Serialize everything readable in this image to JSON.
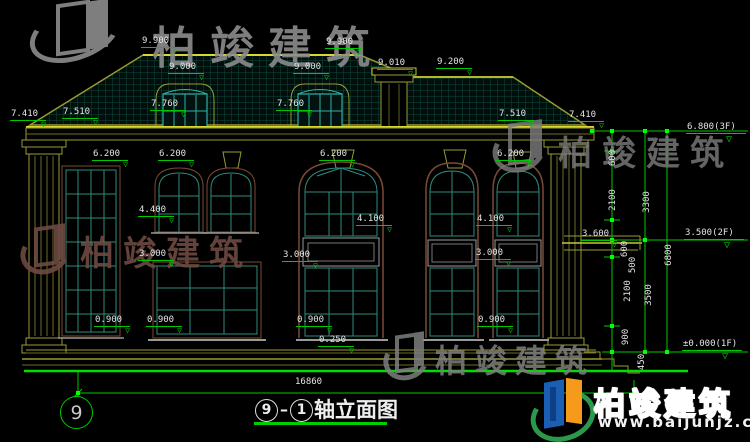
{
  "brand": {
    "name": "柏竣建筑",
    "url": "www.baijunjz.com"
  },
  "figure": {
    "axis_start": "9",
    "separator": "–",
    "axis_end": "1",
    "title": "轴立面图",
    "axis_bubble": "9",
    "total_width": "16860"
  },
  "drawing": {
    "type": "architectural-elevation",
    "floor_levels": [
      "±0.000(1F)",
      "3.500(2F)",
      "6.800(3F)"
    ],
    "colors": {
      "line_green": "#00c800",
      "grip_green": "#00ff00",
      "trim_yellow": "#9a9a35",
      "bright_yellow": "#d8d830",
      "window_teal": "#2e8b7b",
      "frame_brown": "#7a4a35"
    }
  },
  "dim_labels": [
    {
      "t": "9.900",
      "x": 141,
      "y": 36
    },
    {
      "t": "9.900",
      "x": 325,
      "y": 37
    },
    {
      "t": "9.000",
      "x": 168,
      "y": 62
    },
    {
      "t": "9.000",
      "x": 293,
      "y": 62
    },
    {
      "t": "9.010",
      "x": 377,
      "y": 58
    },
    {
      "t": "9.200",
      "x": 436,
      "y": 57
    },
    {
      "t": "7.760",
      "x": 150,
      "y": 99
    },
    {
      "t": "7.760",
      "x": 276,
      "y": 99
    },
    {
      "t": "7.410",
      "x": 10,
      "y": 109
    },
    {
      "t": "7.510",
      "x": 62,
      "y": 107
    },
    {
      "t": "7.510",
      "x": 498,
      "y": 109
    },
    {
      "t": "7.410",
      "x": 568,
      "y": 110
    },
    {
      "t": "6.200",
      "x": 92,
      "y": 149
    },
    {
      "t": "6.200",
      "x": 158,
      "y": 149
    },
    {
      "t": "6.200",
      "x": 319,
      "y": 149
    },
    {
      "t": "6.200",
      "x": 496,
      "y": 149
    },
    {
      "t": "4.400",
      "x": 138,
      "y": 205
    },
    {
      "t": "4.100",
      "x": 356,
      "y": 214
    },
    {
      "t": "4.100",
      "x": 476,
      "y": 214
    },
    {
      "t": "3.000",
      "x": 138,
      "y": 249
    },
    {
      "t": "3.000",
      "x": 282,
      "y": 250
    },
    {
      "t": "3.000",
      "x": 475,
      "y": 248
    },
    {
      "t": "3.600",
      "x": 581,
      "y": 229
    },
    {
      "t": "0.900",
      "x": 94,
      "y": 315
    },
    {
      "t": "0.900",
      "x": 146,
      "y": 315
    },
    {
      "t": "0.900",
      "x": 296,
      "y": 315
    },
    {
      "t": "0.900",
      "x": 477,
      "y": 315
    },
    {
      "t": "0.250",
      "x": 318,
      "y": 335
    },
    {
      "t": "6.800(3F)",
      "x": 686,
      "y": 122,
      "cls": "big"
    },
    {
      "t": "3.500(2F)",
      "x": 684,
      "y": 228,
      "cls": "big"
    },
    {
      "t": "±0.000(1F)",
      "x": 682,
      "y": 339,
      "cls": "big"
    },
    {
      "t": "16860",
      "x": 294,
      "y": 377,
      "cls": "plain"
    }
  ],
  "v_dim_labels": [
    {
      "t": "600",
      "x": 598,
      "y": 153
    },
    {
      "t": "2100",
      "x": 598,
      "y": 195
    },
    {
      "t": "600",
      "x": 610,
      "y": 244
    },
    {
      "t": "500",
      "x": 618,
      "y": 260
    },
    {
      "t": "2100",
      "x": 613,
      "y": 286
    },
    {
      "t": "900",
      "x": 611,
      "y": 332
    },
    {
      "t": "450",
      "x": 627,
      "y": 357
    },
    {
      "t": "3300",
      "x": 632,
      "y": 197
    },
    {
      "t": "3500",
      "x": 634,
      "y": 290
    },
    {
      "t": "6800",
      "x": 654,
      "y": 250
    }
  ]
}
